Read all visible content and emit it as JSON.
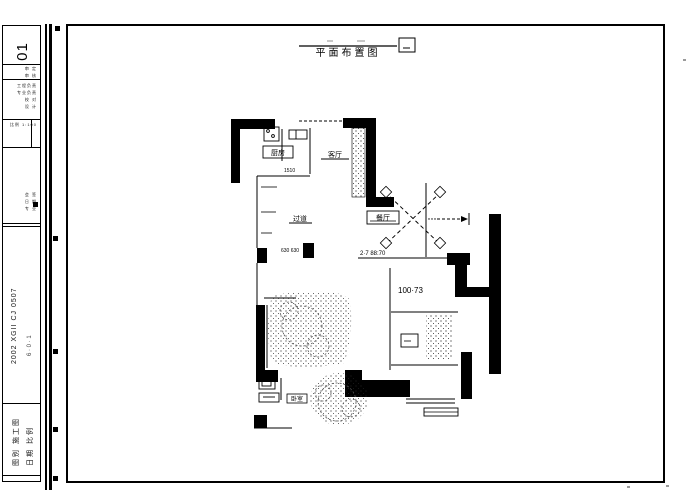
{
  "titleblock": {
    "sheet_number": "01",
    "rows_a": [
      "审 定",
      "审 核"
    ],
    "rows_b": [
      "工程负责",
      "专业负责",
      "校 对",
      "设 计"
    ],
    "scale_row": "比例 1:100",
    "rows_c": [
      "会 签",
      "日 期",
      "专 业"
    ],
    "project_code": "2002 XGII CJ 0507",
    "project_sub": "6 · 0 · 1",
    "footer_col1": "图别 施工图",
    "footer_col2": "日期 比例"
  },
  "drawing": {
    "title": "平面布置图",
    "labels": {
      "kitchen": "厨房",
      "living": "客厅",
      "hallway": "过道",
      "dining": "餐厅",
      "bedroom": "卧室"
    },
    "dims": {
      "dim1": "1510",
      "dim2": "630 630",
      "note1": "2·7 88:70",
      "note2": "100·73"
    }
  }
}
